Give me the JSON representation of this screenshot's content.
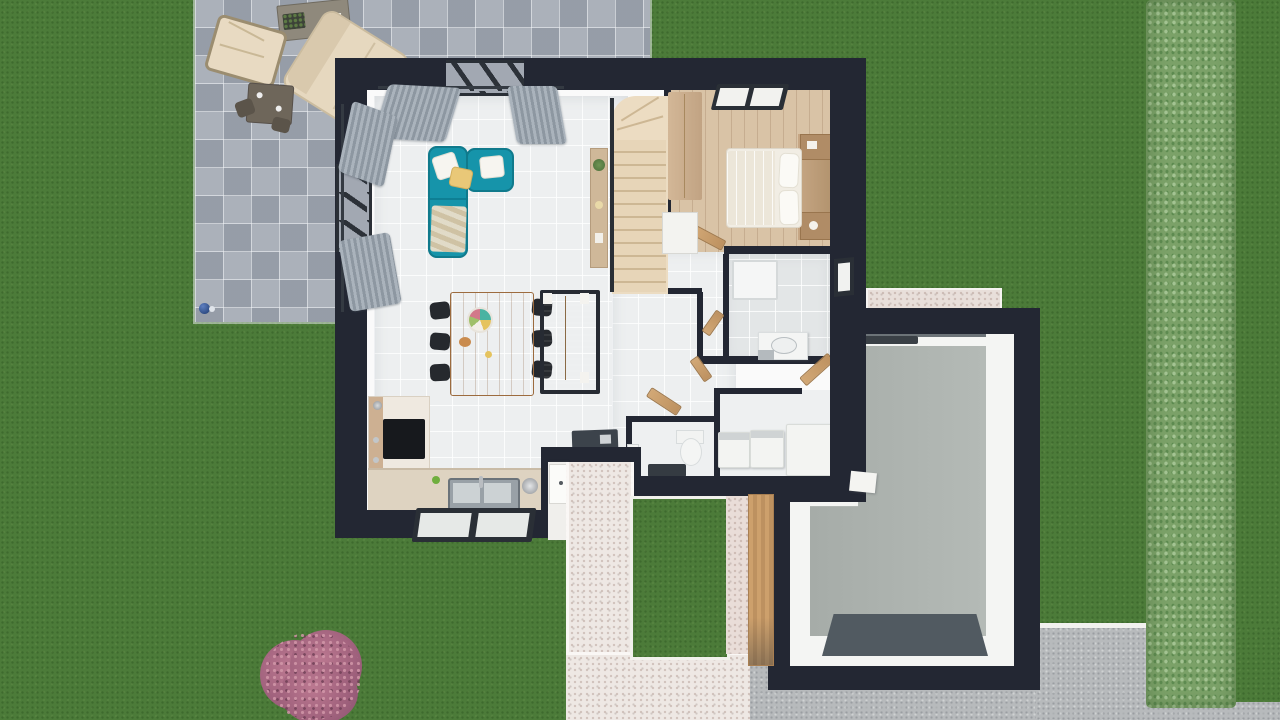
{
  "scene": {
    "description": "Top-down 3D architectural rendering of a single-family house with garden, stone patio, entry walkway and garage",
    "view": "top-down 3d floor plan render"
  },
  "colors": {
    "grass": "#4c7b39",
    "hedge": "#7ba168",
    "paver": "#a2a8b2",
    "wall": "#232733",
    "floor": "#edeff0",
    "bath_floor": "#e3e6e7",
    "wood_floor": "#d9c3a6",
    "stair_wood": "#ecdcc2",
    "sofa": "#1694aa",
    "dining_wood": "#c08654",
    "sideboard_wood": "#b18a63",
    "counter": "#ded3c1",
    "cabinet_wood": "#cdb092",
    "door_wood": "#c69a67",
    "path": "#eee8e4",
    "gravel": "#b7babc",
    "garage_floor": "#aeb4b0",
    "garage_mat": "#515a61",
    "shrub": "#a2607a",
    "curtain": "#98a1ab",
    "appliance": "#f3f4f2",
    "mat_dark": "#3c434b",
    "outdoor_cushion": "#e6d8bf"
  },
  "outdoor": {
    "lawn": {
      "name": "lawn"
    },
    "patio": {
      "name": "stone paver terrace"
    },
    "patio_furniture": [
      {
        "name": "garden table with planter and papers"
      },
      {
        "name": "lounge chair"
      },
      {
        "name": "outdoor sofa"
      },
      {
        "name": "bistro table with chairs"
      },
      {
        "name": "blue garden ball"
      }
    ],
    "hedge": {
      "name": "trimmed hedge along right boundary"
    },
    "shrub": {
      "name": "pink flowering shrub"
    },
    "driveway": {
      "name": "gravel driveway with white curb"
    },
    "walkway": {
      "name": "speckled entry walkway"
    },
    "lawn_inset": {
      "name": "lawn inset in walkway"
    },
    "gravel_strip": {
      "name": "gravel strip above garage"
    }
  },
  "house": {
    "rooms": [
      {
        "id": "living",
        "name": "living room",
        "furniture": [
          "teal corner sofa",
          "throw pillows",
          "plaid",
          "curtains",
          "picture windows"
        ]
      },
      {
        "id": "dining",
        "name": "dining area",
        "furniture": [
          "wooden dining table",
          "six black chairs",
          "decorative platter",
          "sideboard"
        ]
      },
      {
        "id": "kitchen",
        "name": "kitchen",
        "furniture": [
          "L-shaped counter",
          "cooktop",
          "double sink",
          "kettle",
          "toaster",
          "green apple",
          "window"
        ]
      },
      {
        "id": "entry",
        "name": "entry hall",
        "furniture": [
          "dark doormat",
          "front door"
        ]
      },
      {
        "id": "stairs",
        "name": "staircase",
        "furniture": [
          "winder stairs",
          "handrail",
          "console table with plant"
        ]
      },
      {
        "id": "bedroom",
        "name": "bedroom",
        "furniture": [
          "double bed with pillows",
          "headboard shelf",
          "nightstands",
          "wardrobe",
          "white dresser",
          "roof window"
        ]
      },
      {
        "id": "bathroom",
        "name": "bathroom",
        "furniture": [
          "shower tray",
          "washbasin",
          "window"
        ]
      },
      {
        "id": "wc",
        "name": "toilet room",
        "furniture": [
          "toilet",
          "dark mat",
          "hand basin"
        ]
      },
      {
        "id": "laundry",
        "name": "utility room",
        "furniture": [
          "washing machine",
          "dryer",
          "chest freezer"
        ]
      },
      {
        "id": "garage",
        "name": "garage",
        "furniture": [
          "dark floor mat",
          "garage door mechanism",
          "wooden side gate"
        ]
      }
    ]
  }
}
